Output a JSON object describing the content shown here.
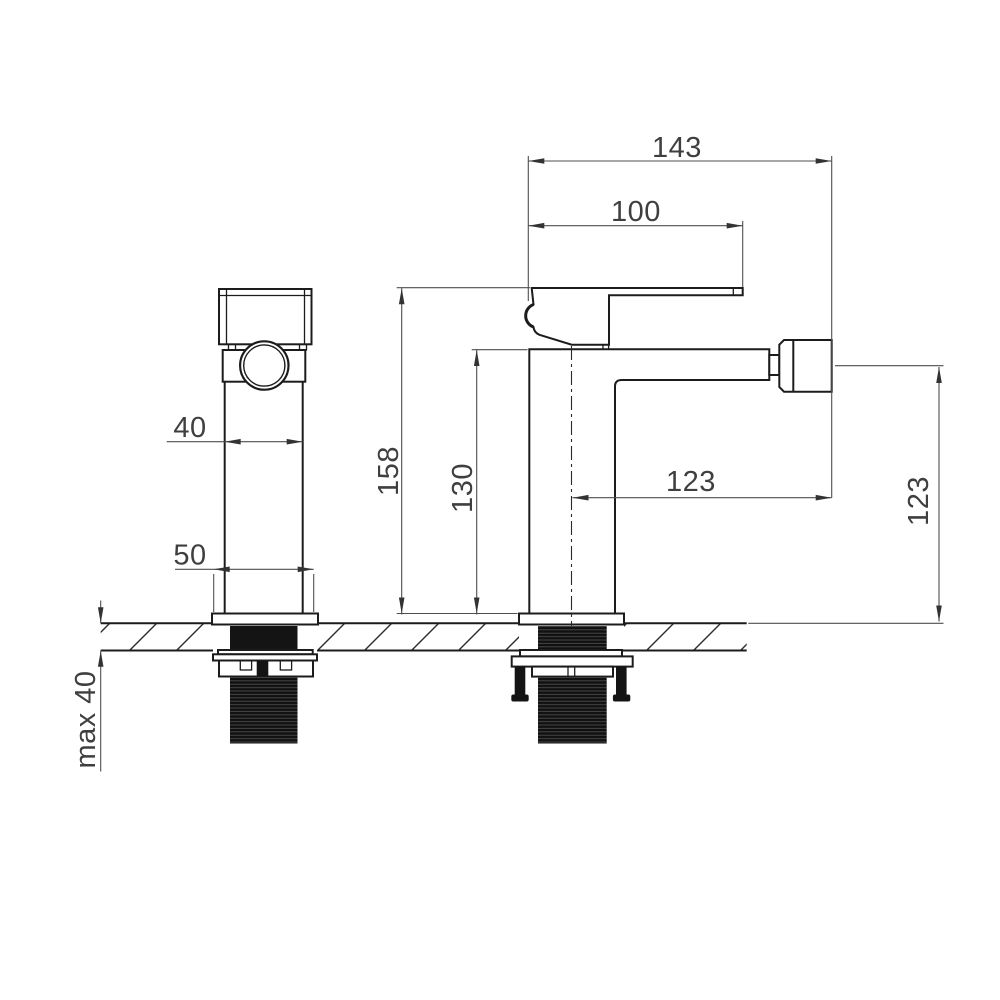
{
  "drawing": {
    "dim_overall_length": "143",
    "dim_handle_length": "100",
    "dim_body_width": "40",
    "dim_base_width": "50",
    "dim_overall_height": "158",
    "dim_body_height": "130",
    "dim_spout_reach": "123",
    "dim_spout_height": "123",
    "dim_max_counter_thickness": "max 40"
  }
}
